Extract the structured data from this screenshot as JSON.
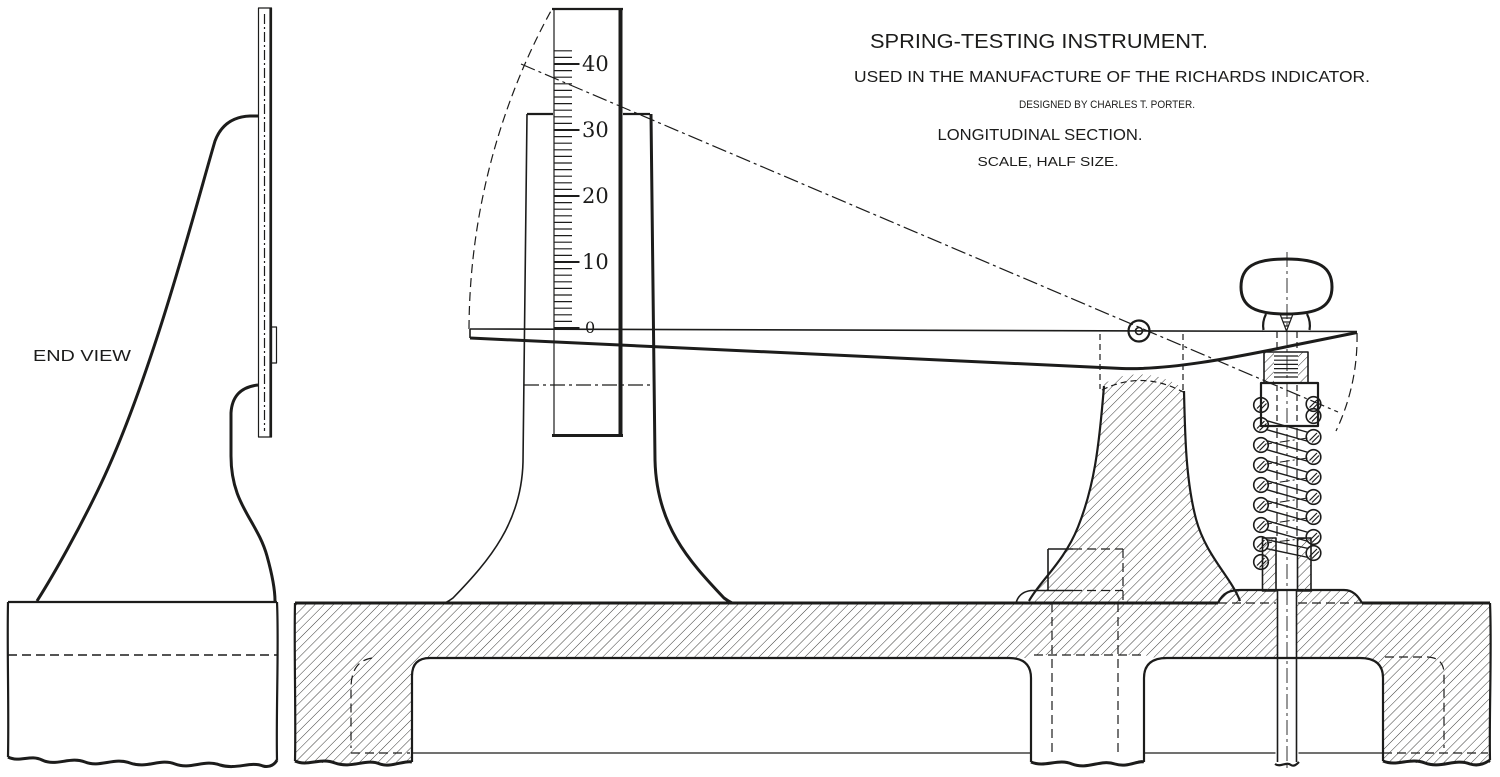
{
  "paper_color": "#ffffff",
  "ink_color": "#1c1c1b",
  "title_block": {
    "title": "SPRING-TESTING INSTRUMENT.",
    "subtitle": "USED IN THE MANUFACTURE OF THE RICHARDS INDICATOR.",
    "credit": "DESIGNED BY CHARLES T. PORTER.",
    "view_label": "LONGITUDINAL SECTION.",
    "scale_note": "SCALE, HALF SIZE."
  },
  "end_view": {
    "label": "END VIEW"
  },
  "scale": {
    "major_labels": [
      "40",
      "30",
      "20",
      "10"
    ],
    "zero_label": "0",
    "tick_values": [
      0,
      10,
      20,
      30,
      40
    ],
    "minor_ticks_per_major": 10
  }
}
